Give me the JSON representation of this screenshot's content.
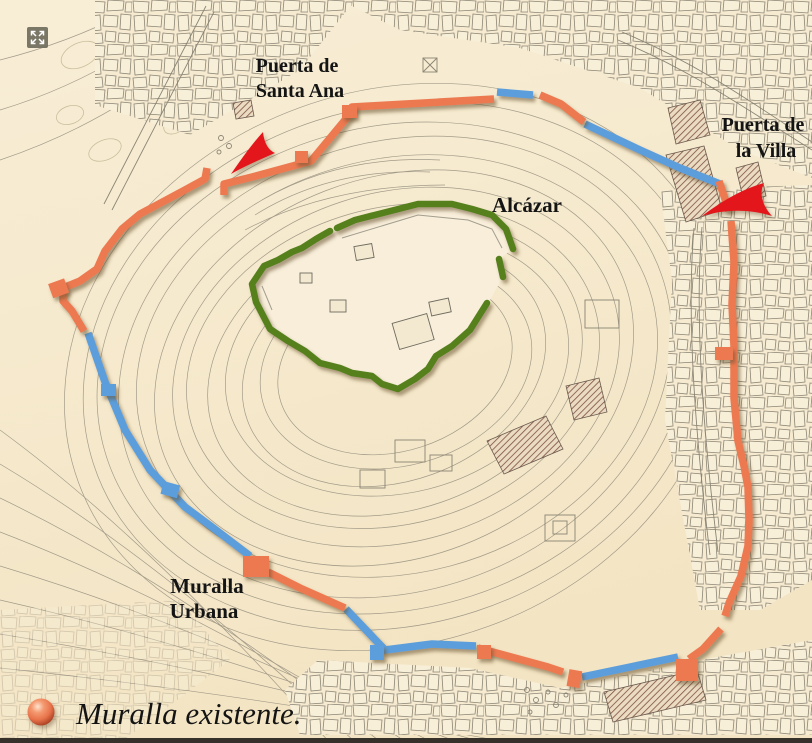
{
  "map": {
    "gates": {
      "santa_ana": {
        "line1": "Puerta de",
        "line2": "Santa Ana"
      },
      "la_villa": {
        "line1": "Puerta de",
        "line2": "la Villa"
      }
    },
    "alcazar_label": "Alcázar",
    "muralla_urbana": {
      "line1": "Muralla",
      "line2": "Urbana"
    }
  },
  "legend": {
    "label": "Muralla existente.",
    "marker_color": "#e8734b"
  },
  "colors": {
    "existing_wall": "#ed7951",
    "other_wall": "#5b9edc",
    "alcazar_outline": "#55801e",
    "gate_arrow": "#e3141c",
    "paper": "#f6e9cd",
    "contour": "#948e7e"
  }
}
